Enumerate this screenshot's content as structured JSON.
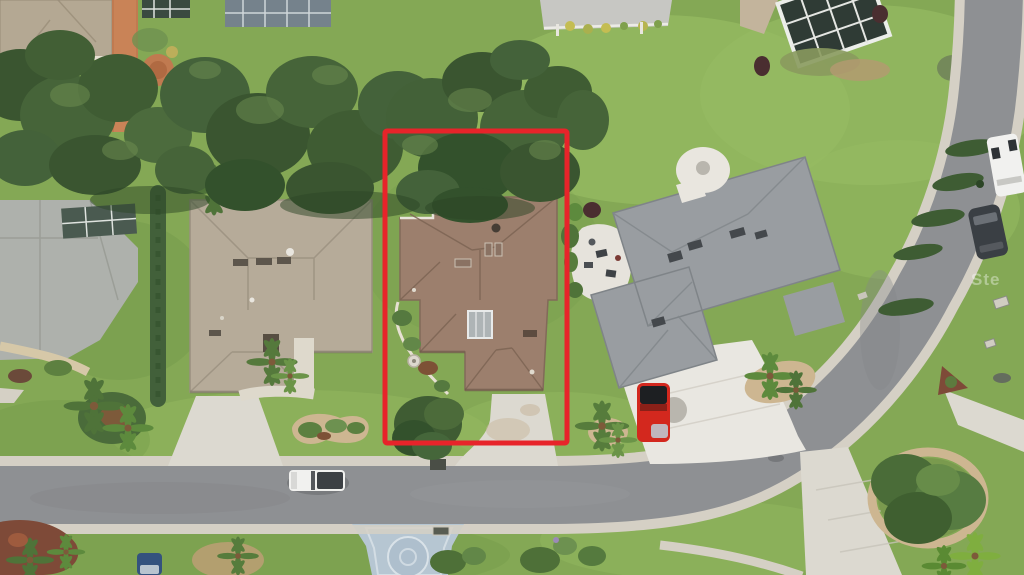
{
  "meta": {
    "type": "aerial-drone-photograph",
    "subject": "suburban single-family homes with one lot outlined in red for a real-estate listing"
  },
  "watermark": {
    "text": "Ste"
  },
  "highlight_box": {
    "x": 385,
    "y": 131,
    "width": 182,
    "height": 312,
    "stroke_width": 5
  },
  "palette": {
    "grass": "#84a855",
    "grass_light": "#96bb62",
    "grass_dark": "#6e9447",
    "canopy": "#3c5731",
    "canopy_light": "#567743",
    "asphalt": "#8e9093",
    "sidewalk": "#d5d0c5",
    "concrete": "#dcd9d0",
    "concrete_bright": "#e9e7e1",
    "roof_left_tan": "#b6ab99",
    "roof_center_brown": "#9c7f6d",
    "roof_right_gray": "#999da1",
    "highlight_red": "#e7242a",
    "truck_red": "#d3281e",
    "car_white": "#f1f1ef",
    "suv_dark": "#3a3f44",
    "car_blue": "#34527e",
    "brick_path": "#c07a50",
    "mulch_red": "#7e4a38",
    "sand_bed": "#cdb691"
  },
  "objects": {
    "houses": [
      "tan-roof house on left lot",
      "brown-roof house inside red highlighted lot",
      "gray-roof house on right lot with circular entry court"
    ],
    "vehicles": [
      "white pickup truck driving on street",
      "red pickup truck parked in right driveway",
      "white van parked along curve",
      "dark SUV parked along curve",
      "blue car at bottom edge"
    ],
    "landscape": [
      "large oak tree canopy across top",
      "row of leaning cypress trees along curved street",
      "palm clusters and kidney-shaped planting beds",
      "blue painted driveway with circular emblem"
    ]
  }
}
